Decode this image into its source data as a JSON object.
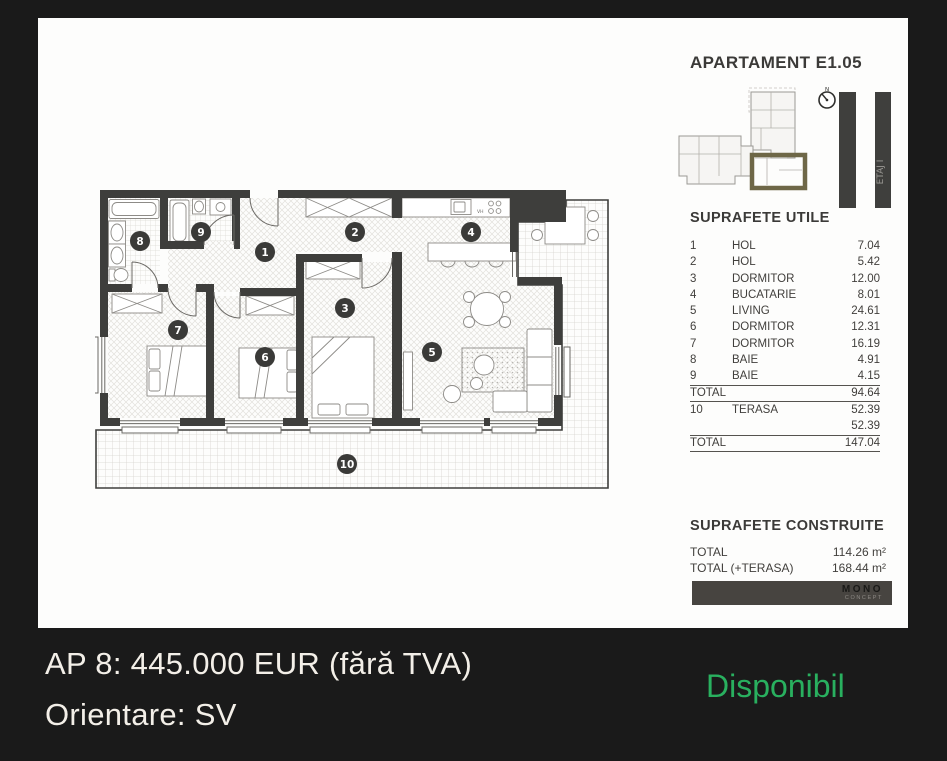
{
  "panel": {
    "apartment_title": "APARTAMENT E1.05",
    "floor_label": "ETAJ I",
    "compass_label": "N",
    "suprafete_utile": {
      "heading": "SUPRAFETE UTILE",
      "rows": [
        {
          "nr": "1",
          "name": "HOL",
          "area": "7.04"
        },
        {
          "nr": "2",
          "name": "HOL",
          "area": "5.42"
        },
        {
          "nr": "3",
          "name": "DORMITOR",
          "area": "12.00"
        },
        {
          "nr": "4",
          "name": "BUCATARIE",
          "area": "8.01"
        },
        {
          "nr": "5",
          "name": "LIVING",
          "area": "24.61"
        },
        {
          "nr": "6",
          "name": "DORMITOR",
          "area": "12.31"
        },
        {
          "nr": "7",
          "name": "DORMITOR",
          "area": "16.19"
        },
        {
          "nr": "8",
          "name": "BAIE",
          "area": "4.91"
        },
        {
          "nr": "9",
          "name": "BAIE",
          "area": "4.15"
        }
      ],
      "total": {
        "label": "TOTAL",
        "value": "94.64"
      },
      "terasa_row": {
        "nr": "10",
        "name": "TERASA",
        "area": "52.39"
      },
      "terasa_extra": "52.39",
      "total_general": {
        "label": "TOTAL",
        "value": "147.04"
      }
    },
    "suprafete_construite": {
      "heading": "SUPRAFETE CONSTRUITE",
      "rows": [
        {
          "label": "TOTAL",
          "value": "114.26 m²"
        },
        {
          "label": "TOTAL (+TERASA)",
          "value": "168.44 m²"
        }
      ]
    },
    "logo": {
      "text": "MONO",
      "subtext": "CONCEPT"
    }
  },
  "plan": {
    "room_numbers": [
      "1",
      "2",
      "3",
      "4",
      "5",
      "6",
      "7",
      "8",
      "9",
      "10"
    ],
    "vh_label": "VH"
  },
  "footer": {
    "price_line": "AP 8: 445.000 EUR (fără TVA)",
    "orientation_line": "Orientare: SV",
    "availability": "Disponibil"
  },
  "colors": {
    "background": "#1a1a1a",
    "panel": "#fdfdfc",
    "walls": "#3e3e3c",
    "accent_olive": "#6e6747",
    "available_green": "#29b05f",
    "footer_text": "#f3efe8"
  }
}
